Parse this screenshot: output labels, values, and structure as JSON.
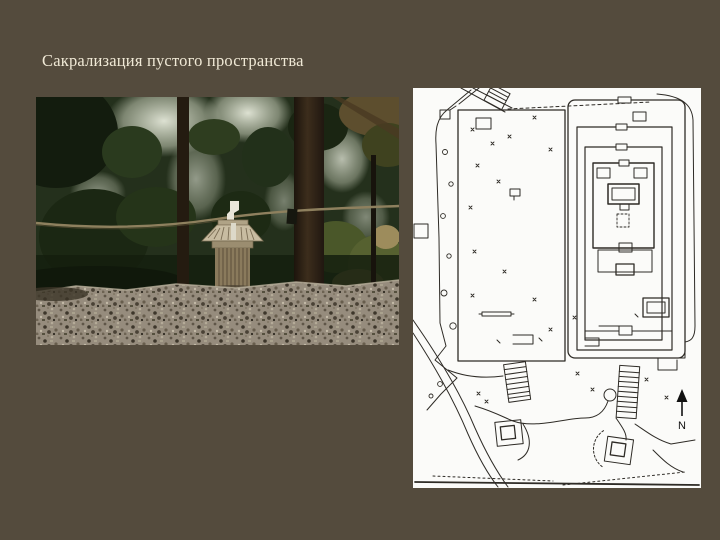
{
  "slide": {
    "title": "Сакрализация пустого пространства",
    "background_color": "#544b3d",
    "title_color": "#f0e9d6"
  },
  "photo": {
    "description": "Photograph of a small wooden Shinto shrine standing on a pebble-covered clearing in a dark forest, behind a horizontally stretched rope with a white paper streamer"
  },
  "plan": {
    "description": "Black-and-white line site plan of a shrine complex: an empty rectangular plot on the left, a nested-fence shrine compound on the right, staircases and winding paths below",
    "compass_label": "N",
    "paper_color": "#fbfbf9",
    "ink_color": "#2e2b26"
  }
}
